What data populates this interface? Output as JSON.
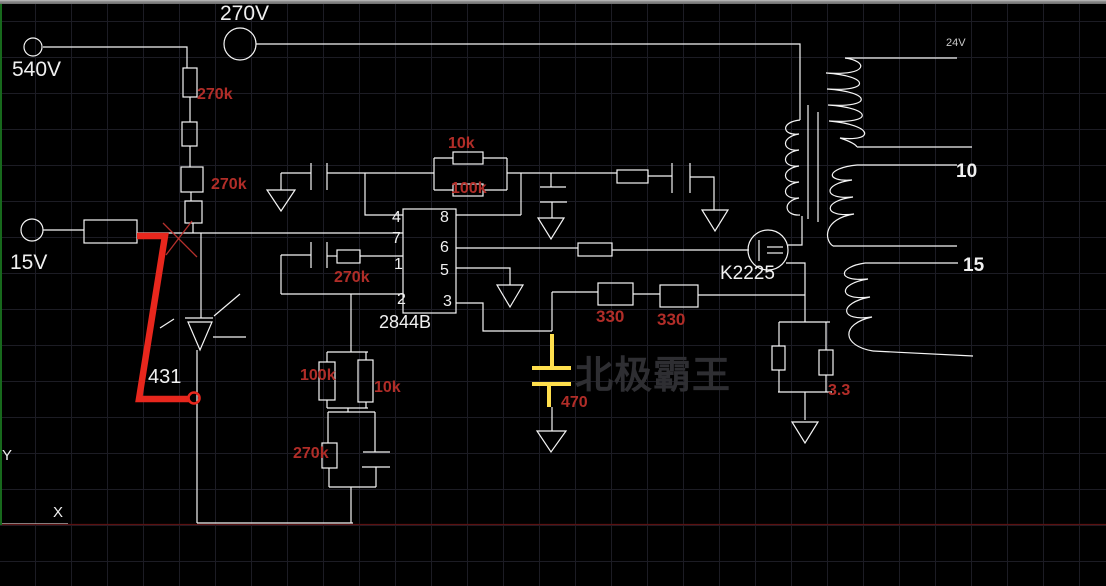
{
  "canvas": {
    "watermark": "北极霸王"
  },
  "terminals": {
    "t540": "540V",
    "t270": "270V",
    "t15": "15V"
  },
  "parts": {
    "ic": "2844B",
    "shunt": "431",
    "mosfet": "K2225"
  },
  "ic_pins": {
    "left": [
      "4",
      "7",
      "1",
      "2"
    ],
    "right": [
      "8",
      "6",
      "5",
      "3"
    ]
  },
  "values": {
    "r_chain_upper": "270k",
    "r_chain_lower": "270k",
    "r_fb_top": "10k",
    "r_fb_bottom": "100k",
    "r_osc": "270k",
    "r_div_left": "100k",
    "r_div_right": "10k",
    "r_low": "270k",
    "r_gate_a": "330",
    "r_gate_b": "330",
    "c_ramp": "470",
    "r_sense": "3.3"
  },
  "transformer": {
    "winding1_v": "24V",
    "winding2_v": "10",
    "winding3_v": "15"
  },
  "ucs": {
    "x": "X",
    "y": "Y"
  },
  "colors": {
    "wire": "#f5f5f5",
    "value_label": "#b12d28",
    "annotation_red": "#e8271d",
    "highlight_yellow": "#ffdf4d",
    "watermark_gray": "#2e2e32",
    "bottom_line_red": "#5a1111",
    "axis_green": "#17691c"
  }
}
